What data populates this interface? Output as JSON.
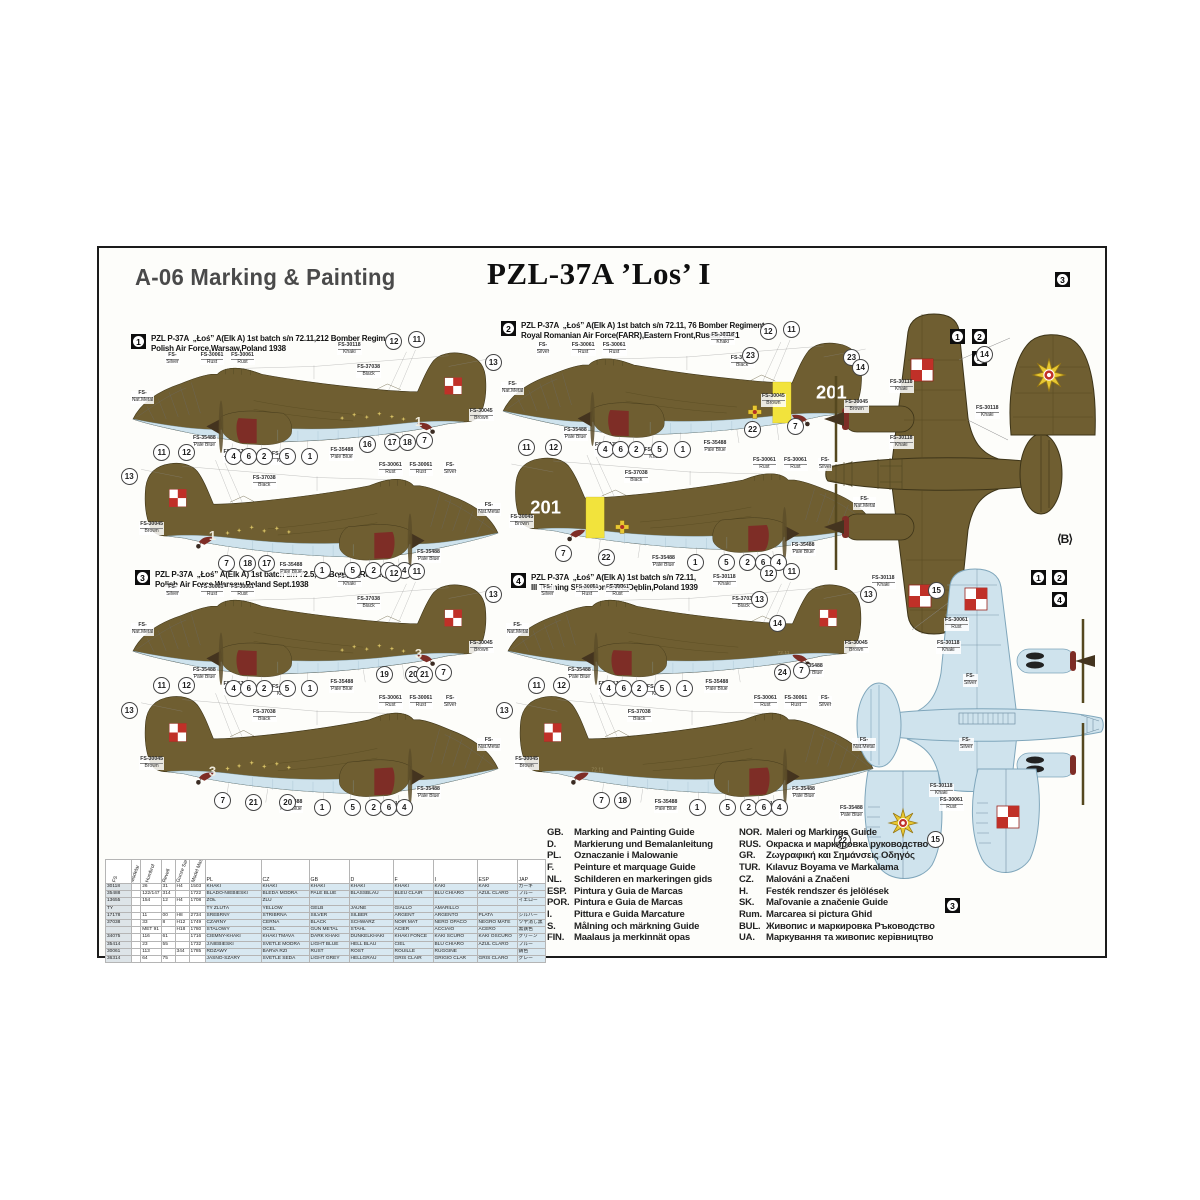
{
  "header": {
    "left_title": "A-06 Marking & Painting",
    "center_title": "PZL-37A ’Los’ I"
  },
  "colors": {
    "khaki": "#6f5e31",
    "khaki_line": "#3d3418",
    "paleblue": "#cfe3ed",
    "paleblue_line": "#7fa6bb",
    "maroon": "#7e2d26",
    "yellow": "#f2e33c",
    "checker_red": "#c03028",
    "emblem_yellow": "#e8c832"
  },
  "schemes": [
    {
      "num": "1",
      "line1": "PZL P-37A  „Łoś” A(Elk A) 1st batch s/n 72.11,212 Bomber Regiment",
      "line2": "Polish Air Force,Warsaw,Poland 1938",
      "tail": "checker",
      "band": false,
      "cross": false,
      "stars": true,
      "digit": "1",
      "callouts_top": [
        [
          "12",
          0.695,
          -0.05
        ],
        [
          "11",
          0.755,
          -0.07
        ],
        [
          "13",
          0.955,
          0.13
        ],
        [
          "4",
          0.275,
          0.97
        ],
        [
          "6",
          0.315,
          0.97
        ],
        [
          "2",
          0.355,
          0.97
        ],
        [
          "5",
          0.415,
          0.97
        ],
        [
          "1",
          0.475,
          0.97
        ],
        [
          "16",
          0.625,
          0.87
        ],
        [
          "17",
          0.69,
          0.85
        ],
        [
          "18",
          0.73,
          0.85
        ],
        [
          "7",
          0.775,
          0.83
        ]
      ],
      "callouts_bottom": [
        [
          "11",
          0.1,
          -0.04
        ],
        [
          "12",
          0.165,
          -0.04
        ],
        [
          "13",
          0.015,
          0.16
        ],
        [
          "7",
          0.27,
          0.9
        ],
        [
          "18",
          0.325,
          0.9
        ],
        [
          "17",
          0.375,
          0.9
        ],
        [
          "1",
          0.52,
          0.96
        ],
        [
          "5",
          0.6,
          0.96
        ],
        [
          "2",
          0.655,
          0.96
        ],
        [
          "6",
          0.695,
          0.96
        ],
        [
          "4",
          0.735,
          0.96
        ]
      ]
    },
    {
      "num": "2",
      "line1": "PZL P-37A  „Łoś” A(Elk A) 1st batch s/n 72.11, 76 Bomber Regiment",
      "line2": "Royal Romanian Air Force(FARR),Eastern Front,Russia 1941",
      "tail": "201",
      "band": true,
      "cross": true,
      "stars": false,
      "digit": "",
      "callouts_top": [
        [
          "12",
          0.695,
          -0.05
        ],
        [
          "11",
          0.755,
          -0.07
        ],
        [
          "23",
          0.91,
          0.17
        ],
        [
          "4",
          0.275,
          0.97
        ],
        [
          "6",
          0.315,
          0.97
        ],
        [
          "2",
          0.355,
          0.97
        ],
        [
          "5",
          0.415,
          0.97
        ],
        [
          "1",
          0.475,
          0.97
        ],
        [
          "22",
          0.655,
          0.8
        ],
        [
          "7",
          0.765,
          0.77
        ]
      ],
      "callouts_bottom": [
        [
          "11",
          0.085,
          -0.04
        ],
        [
          "12",
          0.155,
          -0.04
        ],
        [
          "7",
          0.18,
          0.88
        ],
        [
          "22",
          0.29,
          0.91
        ],
        [
          "1",
          0.52,
          0.96
        ],
        [
          "5",
          0.6,
          0.96
        ],
        [
          "2",
          0.655,
          0.96
        ],
        [
          "6",
          0.695,
          0.96
        ],
        [
          "4",
          0.735,
          0.96
        ]
      ]
    },
    {
      "num": "3",
      "line1": "PZL P-37A  „Łoś” A(Elk A) 1st batch s/n 72.5,212Bomber Regiment,",
      "line2": "Polish Air Force,Warsaw,Poland Sept.1938",
      "tail": "checker",
      "band": false,
      "cross": false,
      "stars": true,
      "digit": "3",
      "callouts_top": [
        [
          "12",
          0.695,
          -0.05
        ],
        [
          "11",
          0.755,
          -0.07
        ],
        [
          "13",
          0.955,
          0.13
        ],
        [
          "4",
          0.275,
          0.97
        ],
        [
          "6",
          0.315,
          0.97
        ],
        [
          "2",
          0.355,
          0.97
        ],
        [
          "5",
          0.415,
          0.97
        ],
        [
          "1",
          0.475,
          0.97
        ],
        [
          "19",
          0.67,
          0.85
        ],
        [
          "20",
          0.745,
          0.85
        ],
        [
          "21",
          0.775,
          0.85
        ],
        [
          "7",
          0.825,
          0.83
        ]
      ],
      "callouts_bottom": [
        [
          "11",
          0.1,
          -0.04
        ],
        [
          "12",
          0.165,
          -0.04
        ],
        [
          "13",
          0.015,
          0.16
        ],
        [
          "7",
          0.26,
          0.9
        ],
        [
          "21",
          0.34,
          0.92
        ],
        [
          "20",
          0.43,
          0.92
        ],
        [
          "1",
          0.52,
          0.96
        ],
        [
          "5",
          0.6,
          0.96
        ],
        [
          "2",
          0.655,
          0.96
        ],
        [
          "6",
          0.695,
          0.96
        ],
        [
          "4",
          0.735,
          0.96
        ]
      ]
    },
    {
      "num": "4",
      "line1": "PZL P-37A  „Łoś” A(Elk A) 1st batch s/n 72.11,",
      "line2": "III Training Squadron CWL,Dęblin,Poland 1939",
      "tail": "checker",
      "band": false,
      "cross": false,
      "stars": false,
      "digit": "72.11",
      "callouts_top": [
        [
          "12",
          0.695,
          -0.05
        ],
        [
          "11",
          0.755,
          -0.07
        ],
        [
          "13",
          0.955,
          0.13
        ],
        [
          "4",
          0.275,
          0.97
        ],
        [
          "6",
          0.315,
          0.97
        ],
        [
          "2",
          0.355,
          0.97
        ],
        [
          "5",
          0.415,
          0.97
        ],
        [
          "1",
          0.475,
          0.97
        ],
        [
          "24",
          0.73,
          0.83
        ],
        [
          "7",
          0.78,
          0.81
        ]
      ],
      "callouts_bottom": [
        [
          "11",
          0.1,
          -0.04
        ],
        [
          "12",
          0.165,
          -0.04
        ],
        [
          "13",
          0.015,
          0.16
        ],
        [
          "7",
          0.27,
          0.9
        ],
        [
          "18",
          0.325,
          0.9
        ],
        [
          "1",
          0.52,
          0.96
        ],
        [
          "5",
          0.6,
          0.96
        ],
        [
          "2",
          0.655,
          0.96
        ],
        [
          "6",
          0.695,
          0.96
        ],
        [
          "4",
          0.735,
          0.96
        ]
      ]
    }
  ],
  "fs_labels_profile": [
    {
      "t": "FS-",
      "s": "Silver",
      "x": 0.1,
      "y": 0.06
    },
    {
      "t": "FS-30061",
      "s": "Rust",
      "x": 0.19,
      "y": 0.06
    },
    {
      "t": "FS-30061",
      "s": "Rust",
      "x": 0.27,
      "y": 0.06
    },
    {
      "t": "FS-30118",
      "s": "Khaki",
      "x": 0.55,
      "y": -0.03
    },
    {
      "t": "FS-37038",
      "s": "Black",
      "x": 0.6,
      "y": 0.17
    },
    {
      "t": "FS-",
      "s": "Nat.Metal",
      "x": 0.01,
      "y": 0.4
    },
    {
      "t": "FS-35488",
      "s": "Pale Blue",
      "x": 0.17,
      "y": 0.8
    },
    {
      "t": "FS-17178",
      "s": "Silver",
      "x": 0.25,
      "y": 0.93
    },
    {
      "t": "FS-35488",
      "s": "Pale Blue",
      "x": 0.53,
      "y": 0.91
    },
    {
      "t": "FS-30045",
      "s": "Brown",
      "x": 0.895,
      "y": 0.56
    }
  ],
  "plan": {
    "top_view_scheme_labels": [
      "1",
      "2",
      "4"
    ],
    "bottom_view_scheme_labels": [
      "1",
      "2",
      "4"
    ],
    "alt_panel_scheme_label": "3",
    "alt_bottom_panel_scheme_label": "3",
    "b_marker": "⟨B⟩",
    "callouts": [
      {
        "n": "23",
        "x": 650,
        "y": 106
      },
      {
        "n": "14",
        "x": 760,
        "y": 118
      },
      {
        "n": "13",
        "x": 659,
        "y": 350
      },
      {
        "n": "14",
        "x": 677,
        "y": 374
      },
      {
        "n": "14",
        "x": 884,
        "y": 105
      },
      {
        "n": "15",
        "x": 836,
        "y": 341
      },
      {
        "n": "22",
        "x": 742,
        "y": 591
      },
      {
        "n": "15",
        "x": 835,
        "y": 590
      }
    ],
    "fs_labels": [
      {
        "t": "FS-30118",
        "s": "Khaki",
        "x": 790,
        "y": 132
      },
      {
        "t": "FS-30118",
        "s": "Khaki",
        "x": 790,
        "y": 188
      },
      {
        "t": "FS-30118",
        "s": "Khaki",
        "x": 772,
        "y": 328
      },
      {
        "t": "FS-30045",
        "s": "Brown",
        "x": 662,
        "y": 146
      },
      {
        "t": "FS-30118",
        "s": "Khaki",
        "x": 876,
        "y": 158
      },
      {
        "t": "FS-30061",
        "s": "Rust",
        "x": 845,
        "y": 370
      },
      {
        "t": "FS-30118",
        "s": "Khaki",
        "x": 837,
        "y": 393
      },
      {
        "t": "FS-",
        "s": "Silver",
        "x": 864,
        "y": 426
      },
      {
        "t": "FS-",
        "s": "Silver",
        "x": 860,
        "y": 490
      },
      {
        "t": "FS-35488",
        "s": "Pale Blue",
        "x": 700,
        "y": 416
      },
      {
        "t": "FS-35488",
        "s": "Pale Blue",
        "x": 740,
        "y": 558
      },
      {
        "t": "FS-30118",
        "s": "Khaki",
        "x": 830,
        "y": 536
      },
      {
        "t": "FS-30061",
        "s": "Rust",
        "x": 840,
        "y": 550
      }
    ]
  },
  "paint_table": {
    "rotated_headers": [
      "FS",
      "Modelar",
      "Humbrol",
      "Revell",
      "Gunze Sangyo",
      "Model Master"
    ],
    "lang_headers": [
      "PL",
      "CZ",
      "GB",
      "D",
      "F",
      "I",
      "ESP",
      "JAP"
    ],
    "rows": [
      [
        "30118",
        "",
        "26",
        "31",
        "H4",
        "1503",
        "KHAKI",
        "KHAKI",
        "KHAKI",
        "KHAKI",
        "KHAKI",
        "KAKI",
        "KAKI",
        "カーキ"
      ],
      [
        "35488",
        "",
        "122/147",
        "314",
        "",
        "1722",
        "BLADO-NIEBIESKI",
        "BLEDÁ MODRÁ",
        "PALE BLUE",
        "BLASSBLAU",
        "BLEU CLAIR",
        "BLU CHIARO",
        "AZUL CLARO",
        "ブルー"
      ],
      [
        "13655",
        "",
        "154",
        "12",
        "H4",
        "1708",
        "ŻÓŁ",
        "ŽLU",
        "",
        "",
        "",
        "",
        "",
        "イエロー"
      ],
      [
        "TY",
        "",
        "",
        "",
        "",
        "",
        "TY  ŽLUTÁ",
        "YELLOW",
        "GELB",
        "JAUNE",
        "GIALLO",
        "AMARILLO",
        "",
        ""
      ],
      [
        "17178",
        "",
        "11",
        "00",
        "H8",
        "2734",
        "SREBRNY",
        "STŘÍBRNÁ",
        "SILVER",
        "SILBER",
        "ARGENT",
        "ARGENTO",
        "PLATA",
        "シルバー"
      ],
      [
        "37038",
        "",
        "33",
        "8",
        "H12",
        "1749",
        "CZARNY",
        "ČERNÁ",
        "BLACK",
        "SCHWARZ",
        "NOIR MAT",
        "NERO OPACO",
        "NEGRO MATE",
        "ツヤ消し黒"
      ],
      [
        "",
        "",
        "MET 91",
        "",
        "H18",
        "1780",
        "STALOWY",
        "OCEL",
        "GUN METAL",
        "STAHL",
        "ACIER",
        "ACCIAIO",
        "ACERO",
        "黒鉄色"
      ],
      [
        "34075",
        "",
        "116",
        "61",
        "",
        "1716",
        "CIEMNY-KHAKI",
        "KHAKI TMAVÁ",
        "DARK KHAKI",
        "DUNKELKHAKI",
        "KHAKI FONCÉ",
        "KAKI SCURO",
        "KAKI OSCURO",
        "グリーン"
      ],
      [
        "35414",
        "",
        "23",
        "55",
        "",
        "1732",
        "J.NIEBIESKI",
        "SVĚTLE MODRÁ",
        "LIGHT BLUE",
        "HELL BLAU",
        "CIEL",
        "BLU CHIARO",
        "AZUL CLARO",
        "ブルー"
      ],
      [
        "30061",
        "",
        "113",
        "",
        "344",
        "1785",
        "RDZAWY",
        "BARVA RZI",
        "RUST",
        "ROST",
        "ROUILLE",
        "RUGGINE",
        "",
        "錆色"
      ],
      [
        "36314",
        "",
        "64",
        "75",
        "",
        "",
        "JASNO-SZARY",
        "SVĚTLE ŠEDÁ",
        "LIGHT GREY",
        "HELLGRAU",
        "GRIS CLAIR",
        "GRIGIO CLAR",
        "GRIS CLARO",
        "グレー"
      ]
    ]
  },
  "legend": {
    "left": [
      [
        "GB.",
        "Marking and Painting Guide"
      ],
      [
        "D.",
        "Markierung und Bemalanleitung"
      ],
      [
        "PL.",
        "Oznaczanie i Malowanie"
      ],
      [
        "F.",
        "Peinture et marquage Guide"
      ],
      [
        "NL.",
        "Schilderen en markeringen gids"
      ],
      [
        "ESP.",
        "Pintura y Guia de Marcas"
      ],
      [
        "POR.",
        "Pintura e Guia de Marcas"
      ],
      [
        "I.",
        "Pittura e Guida Marcature"
      ],
      [
        "S.",
        "Målning och märkning Guide"
      ],
      [
        "FIN.",
        "Maalaus ja merkinnät opas"
      ]
    ],
    "right": [
      [
        "NOR.",
        "Maleri og Markings Guide"
      ],
      [
        "RUS.",
        "Окраска и маркировка руководство"
      ],
      [
        "GR.",
        "Ζωγραφική και Σημάνσεις Οδηγός"
      ],
      [
        "TUR.",
        "Kılavuz Boyama ve Markalama"
      ],
      [
        "CZ.",
        "Malováni a Značeni"
      ],
      [
        "H.",
        "Festék rendszer és jelölések"
      ],
      [
        "SK.",
        "Maľovanie a značenie Guide"
      ],
      [
        "Rum.",
        "Marcarea si pictura Ghid"
      ],
      [
        "BUL.",
        "Живопис и маркировка Ръководство"
      ],
      [
        "UA.",
        "Маркування та живопис керівництво"
      ]
    ]
  }
}
